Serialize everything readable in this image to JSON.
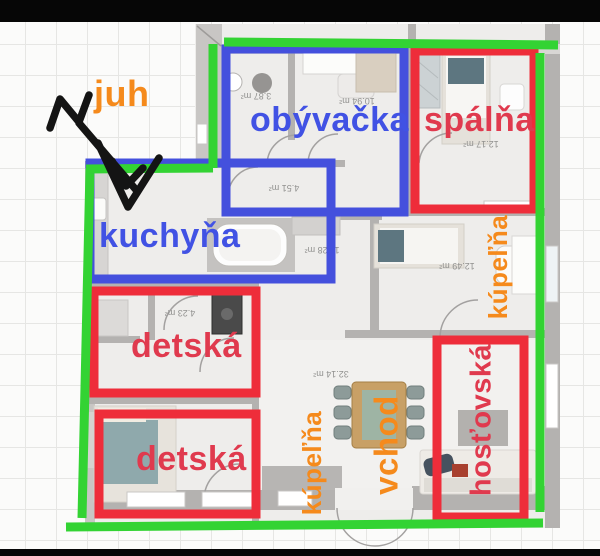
{
  "colors": {
    "annotation_green": "#33d333",
    "annotation_blue": "#4450dd",
    "annotation_red": "#ee2d3a",
    "label_blue": "#4152e4",
    "label_red": "#e03a4e",
    "label_orange": "#f58a1c",
    "area_label_gray": "#91918f",
    "compass_black": "#141414"
  },
  "labels": {
    "juh": "juh",
    "obyvacka": "obývačka",
    "spalna": "spálňa",
    "kuchyna": "kuchyňa",
    "detska_1": "detská",
    "detska_2": "detská",
    "kupelna_right": "kúpeľňa",
    "kupelna_bottom": "kúpeľňa",
    "vchod": "vchod",
    "hostovska": "hosťovská"
  },
  "room_areas": {
    "wc": "3.87 m²",
    "obyvacka": "10.94 m²",
    "spalna": "12.17 m²",
    "hall": "4.51 m²",
    "room_a": "11.28 m²",
    "room_b": "12.49 m²",
    "detska_bath": "4.23 m²",
    "living": "32.14 m²"
  }
}
